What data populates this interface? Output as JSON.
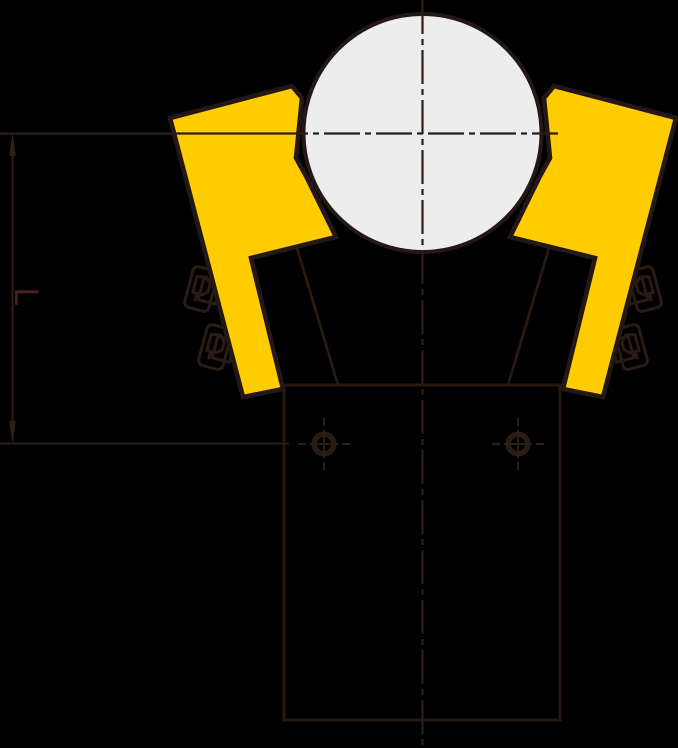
{
  "diagram": {
    "kind": "technical-drawing",
    "dimension": {
      "label": "L"
    },
    "colors": {
      "background": "#000000",
      "line": "#27180f",
      "clamp_arm_fill": "#ffcc00",
      "pipe_fill": "#ededed",
      "dimension_label": "#45231a"
    }
  }
}
